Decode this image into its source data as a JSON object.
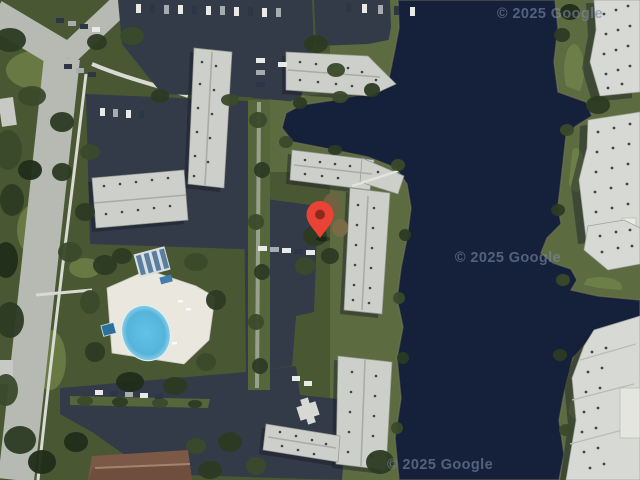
{
  "map": {
    "kind": "satellite-imagery",
    "attribution": {
      "top": "© 2025 Google",
      "middle": "© 2025 Google",
      "bottom": "© 2025 Google"
    },
    "marker": {
      "label": "dropped-pin",
      "color": "#EA4335",
      "dot_color": "#8E2A1D"
    },
    "colors": {
      "water": "#15213B",
      "shore": "#5C6B40",
      "watermark": "#7C89A4",
      "pool_water": "#54B6DC",
      "asphalt": "#333A48",
      "roof": "#CDCFCB",
      "road": "#B6BAB2"
    }
  }
}
